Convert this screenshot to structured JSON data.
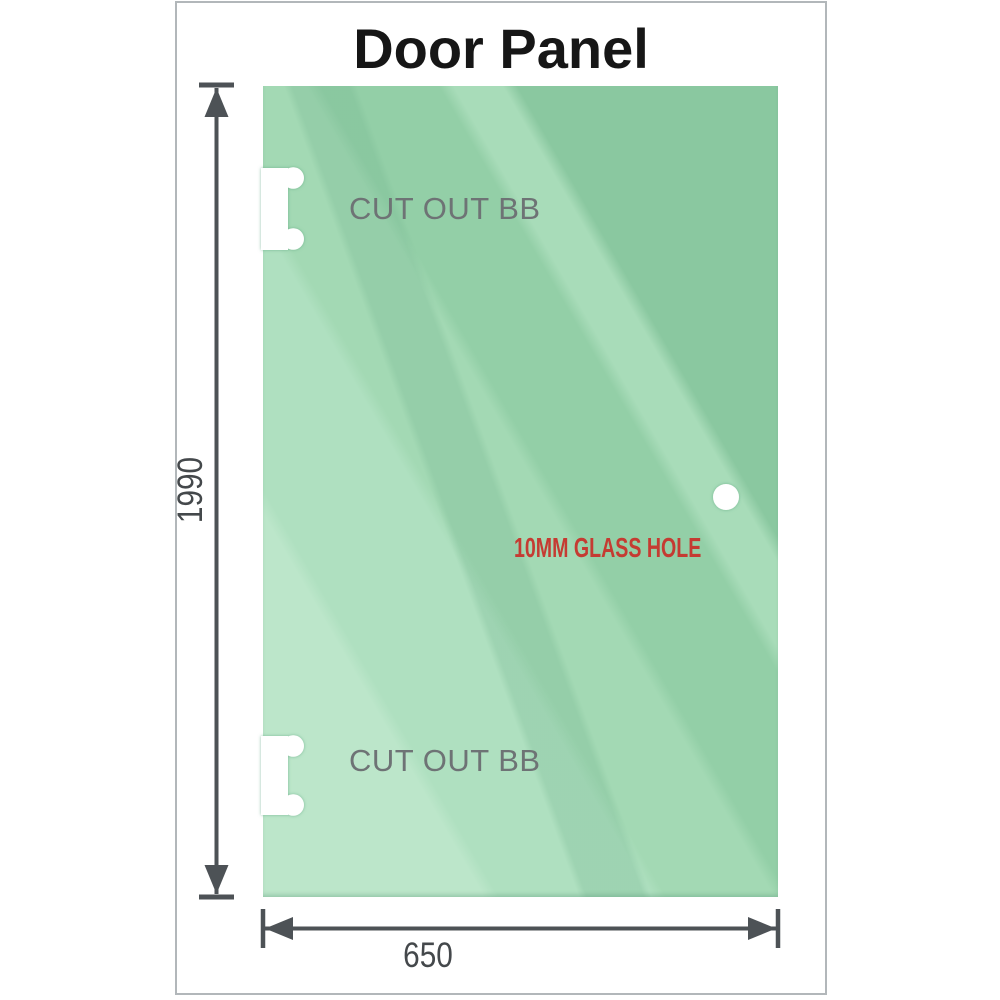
{
  "title": "Door Panel",
  "panel": {
    "cutout_top": {
      "label": "CUT OUT BB"
    },
    "cutout_bottom": {
      "label": "CUT OUT BB"
    },
    "glass_hole": {
      "label": "10MM GLASS HOLE"
    }
  },
  "dimensions": {
    "height_mm": "1990",
    "width_mm": "650"
  },
  "colors": {
    "glass_green_base": "#93cfa7",
    "glass_green_dark": "#8ac8a0",
    "glass_green_light": "#bce6ca",
    "hole_label_red": "#c53b32",
    "dimension_line_gray": "#4d5256",
    "cutout_label_gray": "#6e7375",
    "frame_border_gray": "#b2b7ba",
    "title_black": "#161616"
  }
}
